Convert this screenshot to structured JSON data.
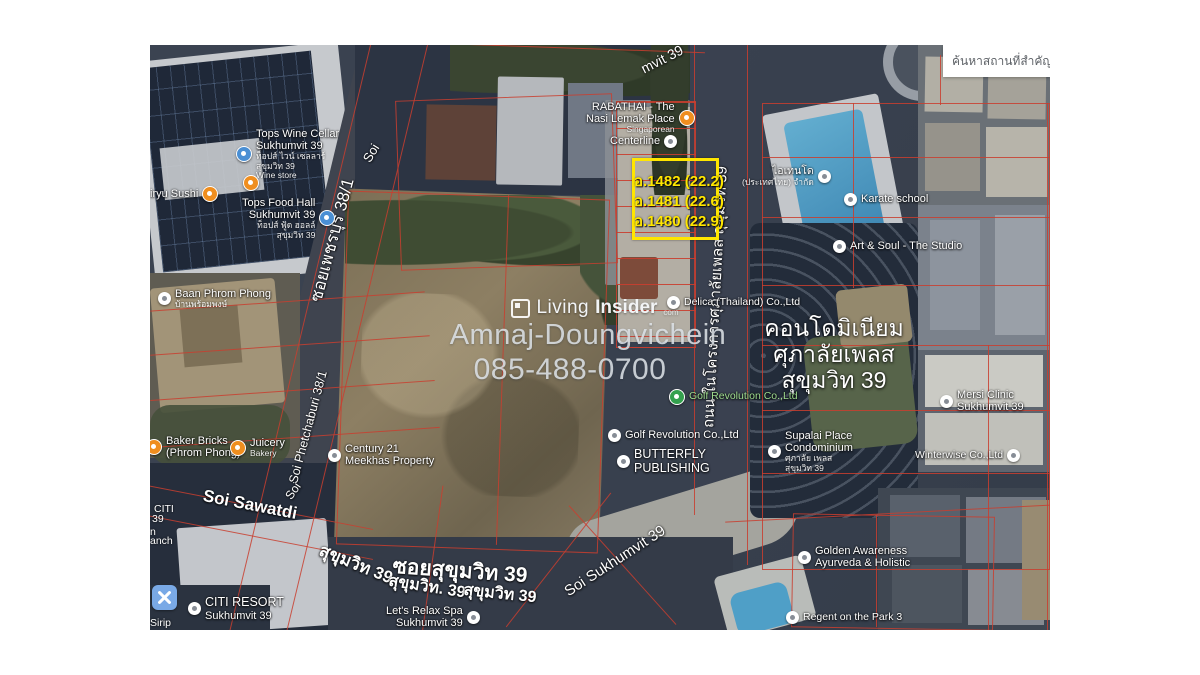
{
  "search_box": {
    "text": "ค้นหาสถานที่สำคัญ"
  },
  "watermark": {
    "brand_first": "Living",
    "brand_second": "Insider",
    "brand_suffix": "com",
    "owner": "Amnaj-Doungvichein",
    "phone": "085-488-0700"
  },
  "highlight_box": {
    "plots": [
      {
        "label": "อ.1482 (22.2)"
      },
      {
        "label": "อ.1481 (22.6)"
      },
      {
        "label": "อ.1480 (22.9)"
      }
    ]
  },
  "condo_overlay": {
    "line1": "คอนโดมิเนียม",
    "line2": "ศุภาลัยเพลส",
    "line3": "สุขุมวิท 39"
  },
  "streets": {
    "phetchaburi_thai": "ซอยเพชรบุรี 38/1",
    "phetchaburi_eng": "Soi Phetchaburi 38/1",
    "soi_top_fragment": "Soi",
    "sukhumvit_top_fragment": "mvit 39",
    "project_road": "ถนน ในโครงการศุภาลัยเพลส สุขุมวิท 39",
    "soi_sawatdi": "Soi Sawatdi",
    "sukhumvit_a": "สุขุมวิท 39",
    "soi_sukhumvit_big": "ซอยสุขุมวิท 39",
    "sukhumvit_b": "สุขุมวิท. 39",
    "sukhumvit_c": "สุขุมวิท 39",
    "soi_sukhumvit_diag": "Soi Sukhumvit 39",
    "soi_bottom_fragment": "Soi"
  },
  "edge_fragments": {
    "f1": "CITI",
    "f2": "39",
    "f3": "n",
    "f4": "anch",
    "f5": "Sirip"
  },
  "pois": {
    "tops_wine_cellar": {
      "line1": "Tops Wine Cellar",
      "line2": "Sukhumvit 39",
      "sub1": "ท็อปส์ ไวน์ เซลลาร์",
      "sub2": "สุขุมวิท 39",
      "extra": "Wine store"
    },
    "kiryu_sushi": {
      "line1": "iryu Sushi"
    },
    "tops_food_hall": {
      "line1": "Tops Food Hall",
      "line2": "Sukhumvit 39",
      "sub1": "ท็อปส์ ฟู้ด ฮอลล์",
      "sub2": "สุขุมวิท 39"
    },
    "baan_phrom_phong": {
      "line1": "Baan Phrom Phong",
      "sub1": "บ้านพร้อมพงษ์"
    },
    "baker_bricks": {
      "line1": "Baker Bricks",
      "line2": "(Phrom Phong)"
    },
    "juicery": {
      "line1": "Juicery",
      "line2": "Bakery"
    },
    "century21": {
      "line1": "Century 21",
      "line2": "Meekhas Property"
    },
    "rabathai": {
      "line1": "RABATHAI - The",
      "line2": "Nasi Lemak Place",
      "sub1": "Singaporean"
    },
    "centerline": {
      "line1": "Centerline"
    },
    "itendo": {
      "line1": "ไอเทนโด",
      "line2": "(ประเทศไทย) จำกัด"
    },
    "karate": {
      "line1": "Karate school"
    },
    "art_soul": {
      "line1": "Art & Soul - The Studio"
    },
    "delica": {
      "line1": "Delica (Thailand) Co.,Ltd"
    },
    "golf_revolution_a": {
      "line1": "Golf Revolution Co.,Ltd"
    },
    "golf_revolution_b": {
      "line1": "Golf Revolution Co.,Ltd"
    },
    "butterfly": {
      "line1": "BUTTERFLY",
      "line2": "PUBLISHING"
    },
    "supalai_place": {
      "line1": "Supalai Place",
      "line2": "Condominium",
      "sub1": "ศุภาลัย เพลส",
      "sub2": "สุขุมวิท 39"
    },
    "mersi": {
      "line1": "Mersi Clinic",
      "line2": "Sukhumvit 39"
    },
    "winterwise": {
      "line1": "Winterwise Co.,Ltd"
    },
    "golden_awareness": {
      "line1": "Golden Awareness",
      "line2": "Ayurveda & Holistic"
    },
    "regent": {
      "line1": "Regent on the Park 3"
    },
    "citi_resort": {
      "line1": "CITI RESORT",
      "line2": "Sukhumvit 39"
    },
    "lets_relax": {
      "line1": "Let's Relax Spa",
      "line2": "Sukhumvit 39"
    }
  },
  "colors": {
    "highlight_yellow": "#ffe600",
    "parcel_red": "#c93e2f",
    "pin_orange": "#ef8e1f",
    "pin_blue": "#4a8fd4",
    "pin_green": "#34a04e",
    "spa_blue": "#79a9e6"
  }
}
